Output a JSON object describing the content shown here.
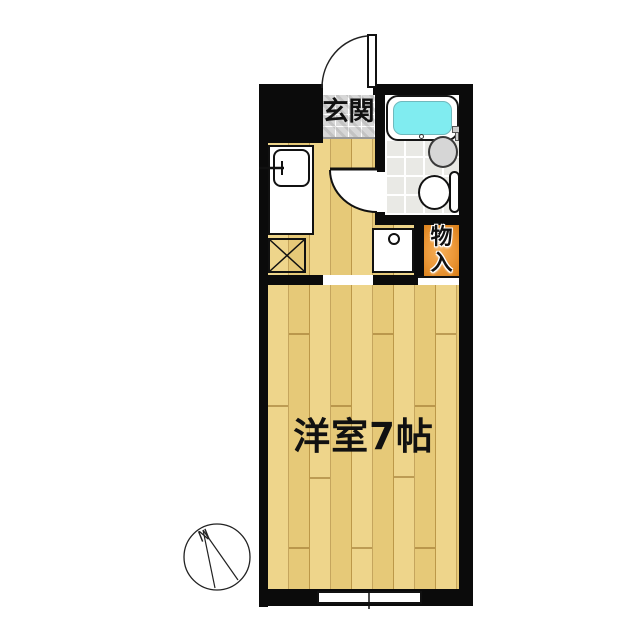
{
  "floorplan": {
    "type_note": "apartment room layout drawing",
    "labels": {
      "entrance": "玄関",
      "storage": "物入",
      "storage_chars": [
        "物",
        "入"
      ],
      "main_room": "洋室7帖",
      "compass_north": "N"
    },
    "colors": {
      "wall": "#0b0b0b",
      "wood_floor": "#ecd07e",
      "wood_plank_line": "#a67f30",
      "entrance_tile": "#d7d7d7",
      "bath_floor_tile": "#e9e9e5",
      "bathtub_water": "#80ecf0",
      "storage_orange": "#eb9737",
      "fixture_gray": "#d6d6d6",
      "background": "#ffffff",
      "text": "#111111"
    },
    "fixtures": [
      "entrance-door",
      "bathroom-door",
      "bathtub",
      "wash-basin",
      "toilet",
      "kitchen-sink",
      "faucet",
      "refrigerator-space",
      "washing-machine-space",
      "storage-closet",
      "window",
      "compass-rose"
    ]
  }
}
